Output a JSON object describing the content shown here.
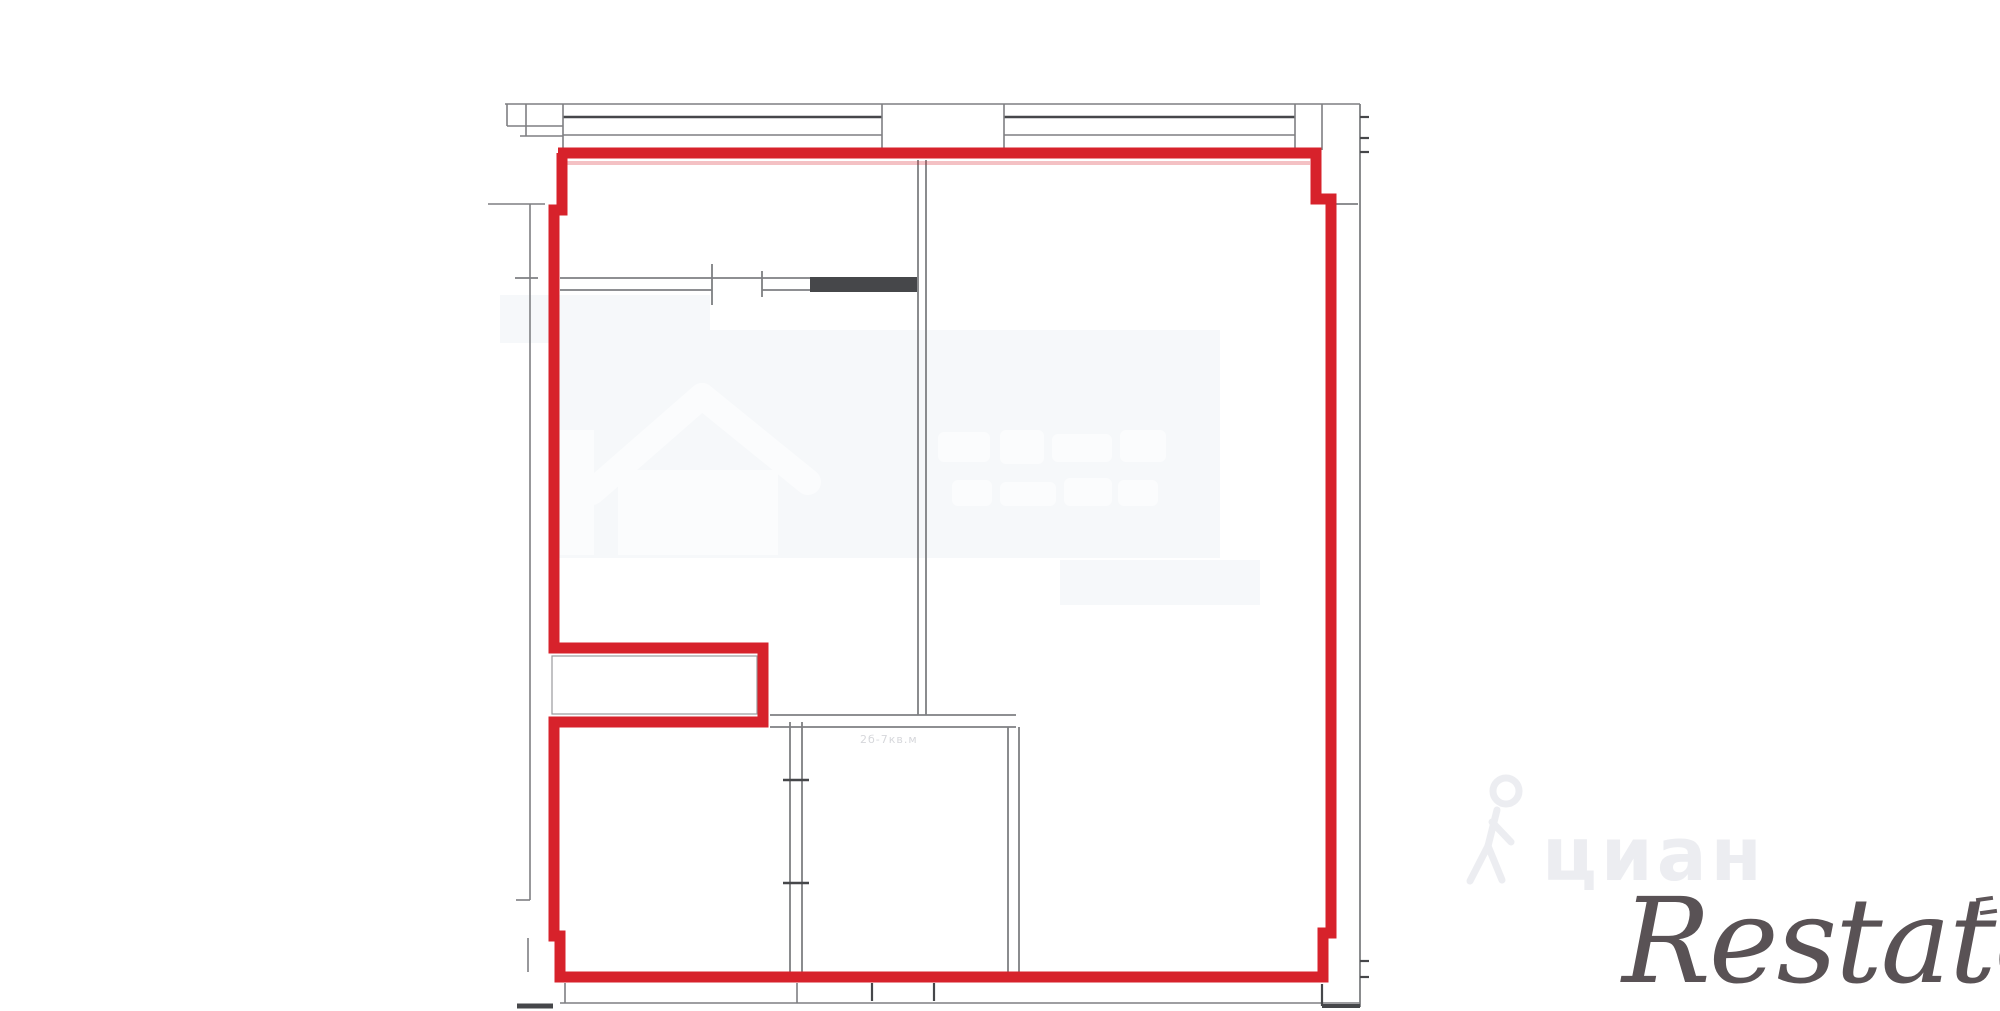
{
  "colors": {
    "red": "#d7222b",
    "red_light": "rgba(215,34,43,0.28)",
    "gray": "#7e7f82",
    "dark": "#46474a",
    "ghost": "#fbfcfd",
    "patch": "#f6f8fa",
    "cian_gray": "#ecedf1",
    "restate_dark": "#4c4447",
    "label_gray": "#d6d7db"
  },
  "plan": {
    "room_label": "2б-7кв.м",
    "red_boundary_points": "558,153 1316,153 1316,199 1331,199 1331,933 1323,933 1323,977 560,977 560,936 554,936 554,722 763,722 763,648 554,648 554,210 562,210 562,153",
    "red_stroke_width": 11,
    "notch_inner_rect": [
      552,
      656,
      205,
      58
    ],
    "solid_wall_rects": [
      [
        810,
        277,
        107,
        15
      ]
    ],
    "background_patches": [
      [
        553,
        330,
        667,
        228
      ],
      [
        500,
        295,
        210,
        48
      ],
      [
        1060,
        560,
        200,
        45
      ]
    ],
    "house_icon_body": [
      618,
      470,
      160,
      85
    ],
    "house_icon_fragment": [
      560,
      430,
      34,
      125
    ],
    "house_icon_roof": [
      [
        592,
        492,
        702,
        396
      ],
      [
        702,
        396,
        808,
        482
      ]
    ],
    "ghost_text_blobs": [
      [
        938,
        432,
        52,
        30
      ],
      [
        1000,
        430,
        44,
        34
      ],
      [
        1052,
        434,
        60,
        28
      ],
      [
        1120,
        430,
        46,
        32
      ],
      [
        952,
        480,
        40,
        26
      ],
      [
        1000,
        482,
        56,
        24
      ],
      [
        1064,
        478,
        48,
        28
      ],
      [
        1118,
        480,
        40,
        26
      ]
    ],
    "gray_lines": [
      [
        505,
        104,
        1360,
        104,
        "gray",
        1.6
      ],
      [
        507,
        104,
        507,
        126,
        "gray",
        1.6
      ],
      [
        507,
        126,
        563,
        126,
        "gray",
        1.6
      ],
      [
        526,
        104,
        526,
        136,
        "gray",
        1.6
      ],
      [
        520,
        136,
        563,
        136,
        "gray",
        1.6
      ],
      [
        563,
        117,
        882,
        117,
        "dark",
        2.4
      ],
      [
        1004,
        117,
        1295,
        117,
        "dark",
        2.4
      ],
      [
        563,
        135,
        882,
        135,
        "gray",
        1.6
      ],
      [
        1004,
        135,
        1295,
        135,
        "gray",
        1.6
      ],
      [
        563,
        104,
        563,
        150,
        "gray",
        1.6
      ],
      [
        882,
        104,
        882,
        150,
        "gray",
        1.6
      ],
      [
        1004,
        104,
        1004,
        150,
        "gray",
        1.6
      ],
      [
        1295,
        104,
        1295,
        150,
        "gray",
        1.6
      ],
      [
        1322,
        104,
        1322,
        150,
        "gray",
        1.6
      ],
      [
        1360,
        104,
        1360,
        1007,
        "gray",
        1.8
      ],
      [
        1360,
        117,
        1369,
        117,
        "dark",
        2.2
      ],
      [
        1360,
        138,
        1369,
        138,
        "dark",
        2.2
      ],
      [
        1360,
        152,
        1369,
        152,
        "dark",
        2.2
      ],
      [
        1360,
        961,
        1369,
        961,
        "dark",
        2.2
      ],
      [
        1360,
        977,
        1369,
        977,
        "dark",
        2.2
      ],
      [
        1332,
        204,
        1358,
        204,
        "gray",
        1.8
      ],
      [
        488,
        204,
        545,
        204,
        "gray",
        1.6
      ],
      [
        530,
        204,
        530,
        900,
        "gray",
        1.6
      ],
      [
        516,
        900,
        530,
        900,
        "gray",
        1.6
      ],
      [
        515,
        278,
        538,
        278,
        "gray",
        1.8
      ],
      [
        528,
        938,
        528,
        972,
        "gray",
        1.6
      ],
      [
        560,
        278,
        917,
        278,
        "gray",
        1.8
      ],
      [
        560,
        290,
        712,
        290,
        "gray",
        1.8
      ],
      [
        762,
        290,
        810,
        290,
        "gray",
        1.8
      ],
      [
        712,
        264,
        712,
        305,
        "gray",
        1.8
      ],
      [
        762,
        271,
        762,
        297,
        "gray",
        1.8
      ],
      [
        918,
        160,
        918,
        715,
        "gray",
        1.8
      ],
      [
        926,
        160,
        926,
        715,
        "gray",
        1.8
      ],
      [
        770,
        715,
        1016,
        715,
        "gray",
        1.8
      ],
      [
        770,
        727,
        1016,
        727,
        "gray",
        1.8
      ],
      [
        1008,
        727,
        1008,
        972,
        "gray",
        1.8
      ],
      [
        1019,
        727,
        1019,
        972,
        "gray",
        1.8
      ],
      [
        790,
        722,
        790,
        972,
        "gray",
        1.8
      ],
      [
        802,
        722,
        802,
        972,
        "gray",
        1.8
      ],
      [
        783,
        780,
        809,
        780,
        "dark",
        2.4
      ],
      [
        783,
        883,
        809,
        883,
        "dark",
        2.4
      ],
      [
        560,
        1003,
        1360,
        1003,
        "gray",
        1.6
      ],
      [
        565,
        983,
        565,
        1003,
        "gray",
        1.6
      ],
      [
        797,
        983,
        797,
        1003,
        "gray",
        1.6
      ],
      [
        872,
        983,
        872,
        1001,
        "dark",
        2.2
      ],
      [
        934,
        983,
        934,
        1001,
        "dark",
        2.2
      ],
      [
        1322,
        984,
        1322,
        1006,
        "dark",
        2.2
      ],
      [
        517,
        1006,
        553,
        1006,
        "dark",
        5
      ],
      [
        1322,
        1006,
        1360,
        1006,
        "dark",
        4
      ],
      [
        560,
        163,
        1310,
        163,
        "red_light",
        4
      ]
    ],
    "cian_person_icon": {
      "head": [
        1506,
        791,
        13
      ],
      "strokes": [
        [
          1497,
          810,
          1488,
          846
        ],
        [
          1488,
          846,
          1470,
          881
        ],
        [
          1488,
          846,
          1502,
          880
        ],
        [
          1492,
          822,
          1511,
          842
        ]
      ]
    }
  },
  "watermarks": {
    "cian": {
      "text": "циан",
      "icon": "person-walking-icon"
    },
    "restate": {
      "text": "Restate"
    },
    "center": {
      "icon": "house-icon"
    }
  }
}
